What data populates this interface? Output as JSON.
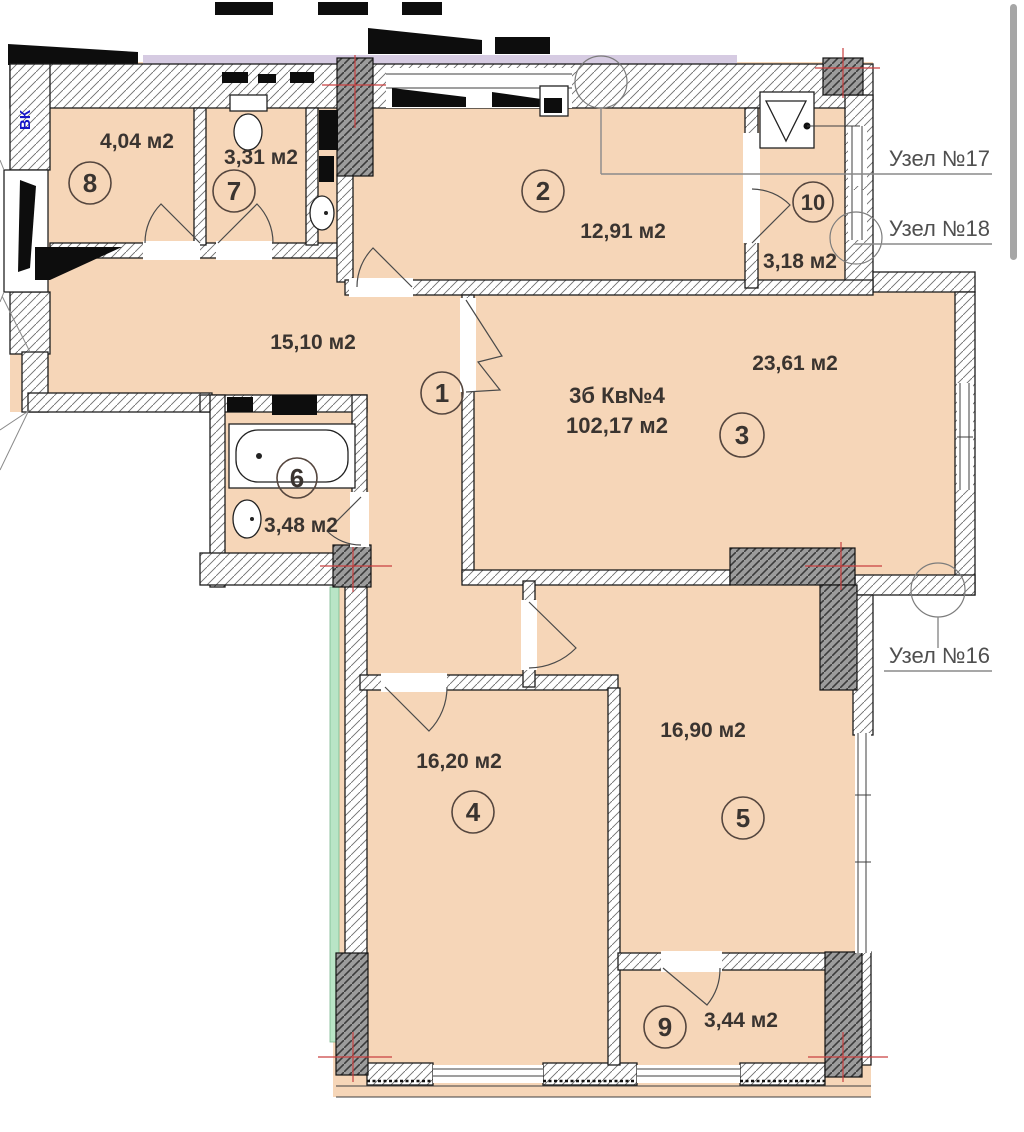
{
  "plan": {
    "title_line1": "3б Кв№4",
    "title_line2": "102,17 м2",
    "rooms": [
      {
        "num": "1",
        "area": "15,10 м2"
      },
      {
        "num": "2",
        "area": "12,91 м2"
      },
      {
        "num": "3",
        "area": "23,61 м2"
      },
      {
        "num": "4",
        "area": "16,20 м2"
      },
      {
        "num": "5",
        "area": "16,90 м2"
      },
      {
        "num": "6",
        "area": "3,48 м2"
      },
      {
        "num": "7",
        "area": "3,31 м2"
      },
      {
        "num": "8",
        "area": "4,04 м2"
      },
      {
        "num": "9",
        "area": "3,44 м2"
      },
      {
        "num": "10",
        "area": "3,18 м2"
      }
    ],
    "callouts": [
      {
        "label": "Узел №17"
      },
      {
        "label": "Узел №18"
      },
      {
        "label": "Узел №16"
      }
    ],
    "duct_label": "ВК",
    "colors": {
      "room_fill": "#f6d6b8",
      "wall_line": "#1d1d1d",
      "column_fill": "#9a9a9a",
      "centerline_red": "#c94040",
      "accent_green": "#b9e5c6",
      "accent_purple": "#d6cbe2",
      "water_blue": "#1616c8",
      "text_color": "#3a3430",
      "callout_color": "#4f4f4f",
      "scrollbar_color": "#a6a6a6"
    }
  }
}
